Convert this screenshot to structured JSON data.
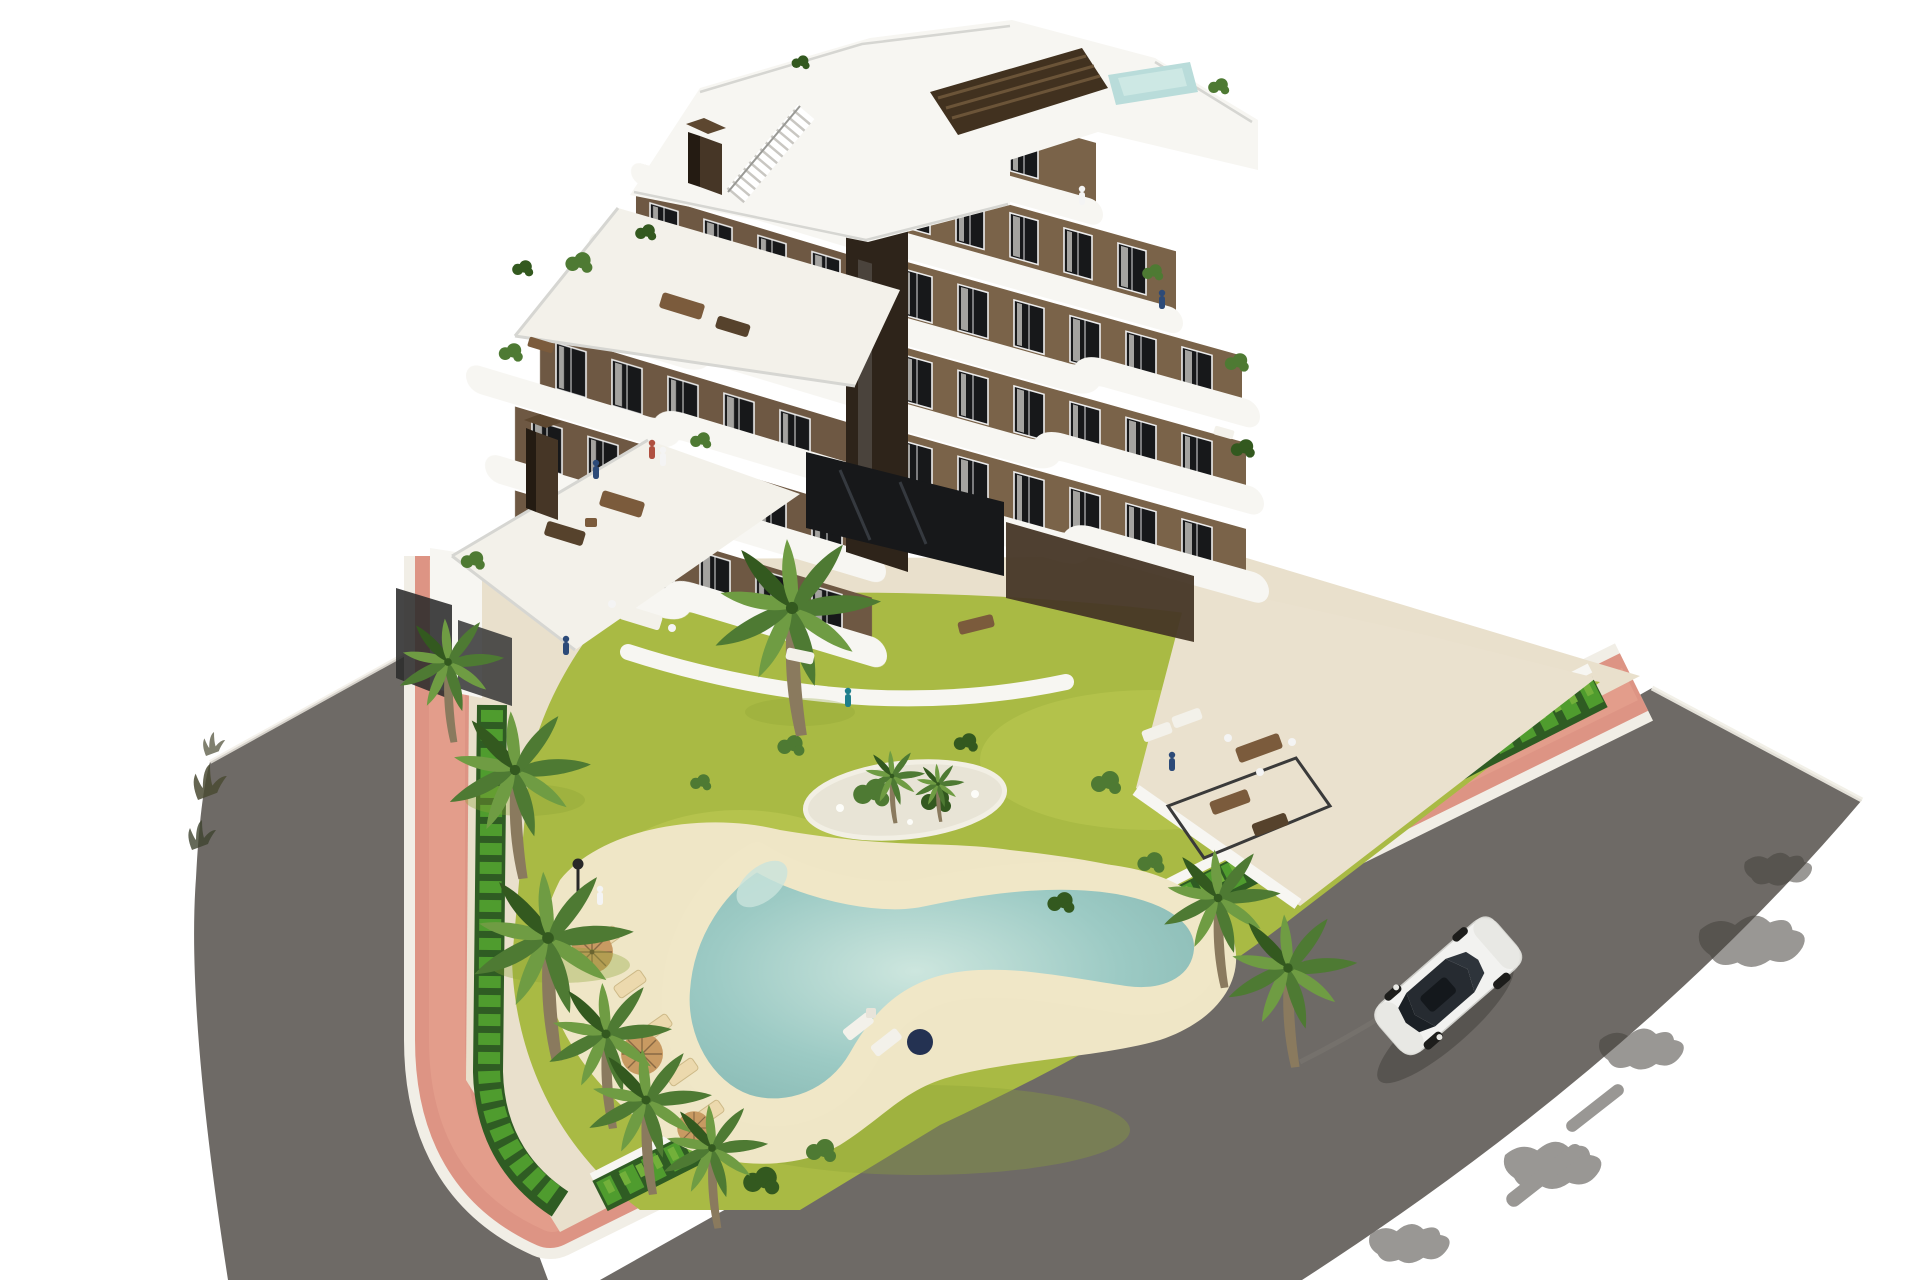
{
  "image_type": "3d-architectural-rendering",
  "scene": {
    "description": "Aerial 3D render of a modern stepped apartment block with curved white balcony bands and brown facades, set in a landscaped plot with lawn, palm trees, a freeform sand-edged pool, salmon-pink sidewalks and two asphalt roads; a single white car drives on the right road.",
    "building": {
      "storeys": 7,
      "facade_color_name": "brown",
      "balcony_color_name": "white",
      "features": [
        "rooftop plunge pool",
        "rooftop stair with slatted screen",
        "two chimneys",
        "curved white balcony bands",
        "roof terraces with furniture",
        "floor-to-ceiling dark windows"
      ]
    },
    "garden": {
      "lawn": true,
      "plant_island": true,
      "perimeter_hedge": true,
      "palm_trees": 12,
      "garden_walls": "white with dark gates"
    },
    "pool": {
      "shape": "freeform boomerang",
      "edge": "sand colored",
      "sun_loungers": 7,
      "parasols": 4
    },
    "roads": {
      "left_road": "dark asphalt, curved",
      "right_road": "dark asphalt, diagonal with tree shadows",
      "sidewalk": "salmon pink pavers with white curbs",
      "vehicles": 1
    },
    "car": {
      "color": "white",
      "type": "sedan",
      "heading": "down-left"
    },
    "people_visible": 9
  },
  "palette": {
    "asphalt": "#6e6a66",
    "asphalt-dark": "#45423d",
    "curb": "#f1eee6",
    "pink": "#dd9484",
    "pink-light": "#eaa995",
    "garden-base": "#e9e0cc",
    "pavement": "#eae1ce",
    "sand": "#efe6c6",
    "grass": "#a9ba44",
    "grass-light": "#c3cf58",
    "grass-dark": "#8da336",
    "hedge-dark": "#2f5c23",
    "hedge-mid": "#4f9c2e",
    "hedge-light": "#72b03a",
    "pool-rim": "#f0e7c7",
    "pool-water": "#9ccac4",
    "pool-light": "#c9e4dc",
    "pool-deep": "#84b6b0",
    "white-build": "#f7f6f2",
    "white-soft": "#f3f1ea",
    "band-shadow": "#d9d6cf",
    "fac-l": "#6e5843",
    "fac-r": "#7a6349",
    "fac-dark": "#463626",
    "notch": "#2e241a",
    "glass-dark": "#17181a",
    "frame": "#ececec",
    "slat": "#41311f",
    "slat-line": "#6b5438",
    "trunk": "#8a7a5e",
    "palm-a": "#4e7a33",
    "palm-b": "#6f9c43",
    "palm-dark": "#33591f",
    "furn": "#7b5b3c",
    "furn-dark": "#56422c",
    "car-body": "#f2f2f0",
    "car-glass": "#262b31",
    "shadow": "#3c3a36",
    "fig-navy": "#2c4a78",
    "fig-teal": "#1f7f8c",
    "fig-red": "#b0503f",
    "fig-white": "#f4f4f4",
    "lamp": "#282828",
    "umb": "#c89a62",
    "umb-navy": "#243252",
    "lounger": "#ecd9ad",
    "rail": "#d6d6d2",
    "pebble": "#e8e4d6"
  }
}
